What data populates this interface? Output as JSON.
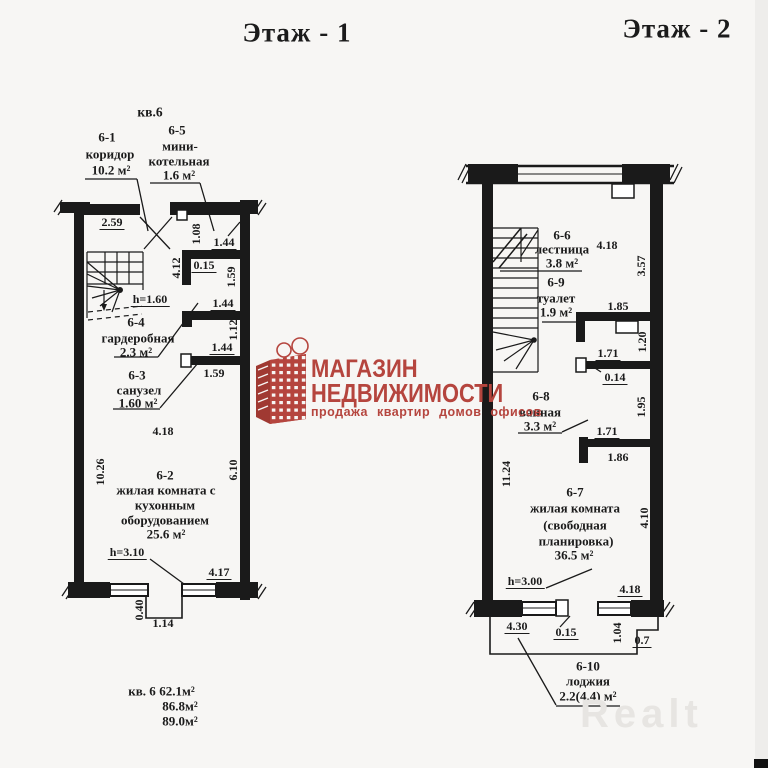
{
  "floor1": {
    "title": "Этаж - 1",
    "apt": "кв.6",
    "rooms": {
      "r61_id": "6-1",
      "r61_name": "коридор",
      "r61_area": "10.2 м²",
      "r65_id": "6-5",
      "r65_name1": "мини-",
      "r65_name2": "котельная",
      "r65_area": "1.6 м²",
      "r64_id": "6-4",
      "r64_name": "гардеробная",
      "r64_area": "2.3 м²",
      "r63_id": "6-3",
      "r63_name": "санузел",
      "r63_area": "1.60 м²",
      "r62_id": "6-2",
      "r62_name1": "жилая комната с",
      "r62_name2": "кухонным",
      "r62_name3": "оборудованием",
      "r62_area": "25.6 м²",
      "h_stair": "h=1.60",
      "h_room": "h=3.10"
    },
    "dims": {
      "d259": "2.59",
      "d108": "1.08",
      "d144a": "1.44",
      "d412": "4.12",
      "d015": "0.15",
      "d159a": "1.59",
      "d144b": "1.44",
      "d112": "1.12",
      "d144c": "1.44",
      "d159b": "1.59",
      "d418": "4.18",
      "d1026": "10.26",
      "d610": "6.10",
      "d417": "4.17",
      "d040": "0.40",
      "d114": "1.14"
    },
    "totals": {
      "apt": "кв. 6",
      "a1": "62.1м²",
      "a2": "86.8м²",
      "a3": "89.0м²"
    }
  },
  "floor2": {
    "title": "Этаж - 2",
    "rooms": {
      "r66_id": "6-6",
      "r66_name": "лестница",
      "r66_area": "3.8 м²",
      "r69_id": "6-9",
      "r69_name": "туалет",
      "r69_area": "1.9 м²",
      "r68_id": "6-8",
      "r68_name": "ванная",
      "r68_area": "3.3 м²",
      "r67_id": "6-7",
      "r67_name1": "жилая комната",
      "r67_name2": "(свободная",
      "r67_name3": "планировка)",
      "r67_area": "36.5 м²",
      "r610_id": "6-10",
      "r610_name": "лоджия",
      "r610_area": "2.2(4.4) м²",
      "h_room": "h=3.00"
    },
    "dims": {
      "d418a": "4.18",
      "d357": "3.57",
      "d185": "1.85",
      "d120": "1.20",
      "d171a": "1.71",
      "d014": "0.14",
      "d195": "1.95",
      "d171b": "1.71",
      "d186": "1.86",
      "d1124": "11.24",
      "d410": "4.10",
      "d418b": "4.18",
      "d430": "4.30",
      "d015": "0.15",
      "d104": "1.04",
      "d07": "0.7"
    }
  },
  "logo": {
    "line1": "МАГАЗИН",
    "line2": "НЕДВИЖИМОСТИ",
    "tagline": "продажа квартир домов офисов",
    "color": "#b5453e"
  },
  "watermark": {
    "text": "Realt"
  }
}
